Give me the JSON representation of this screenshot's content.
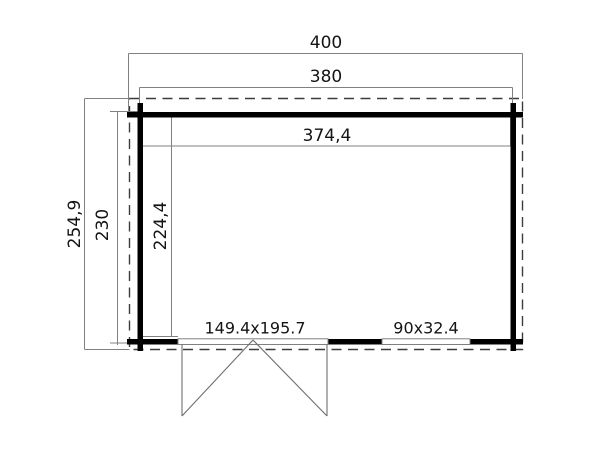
{
  "drawing": {
    "type": "floor-plan",
    "description": "Top-view floor plan of a log cabin with roof overhang (dashed), log walls (solid black), a double door and one window in the bottom wall",
    "labels": {
      "roof_width": "400",
      "wall_width": "380",
      "interior_width": "374,4",
      "roof_depth": "254,9",
      "wall_depth": "230",
      "interior_depth": "224,4",
      "door_size": "149.4x195.7",
      "window_size": "90x32.4"
    },
    "colors": {
      "background": "#ffffff",
      "wall": "#000000",
      "thin_line": "#808080",
      "dashed_line": "#3c3c3c",
      "door_line": "#6e6e6e",
      "text": "#141414"
    }
  }
}
